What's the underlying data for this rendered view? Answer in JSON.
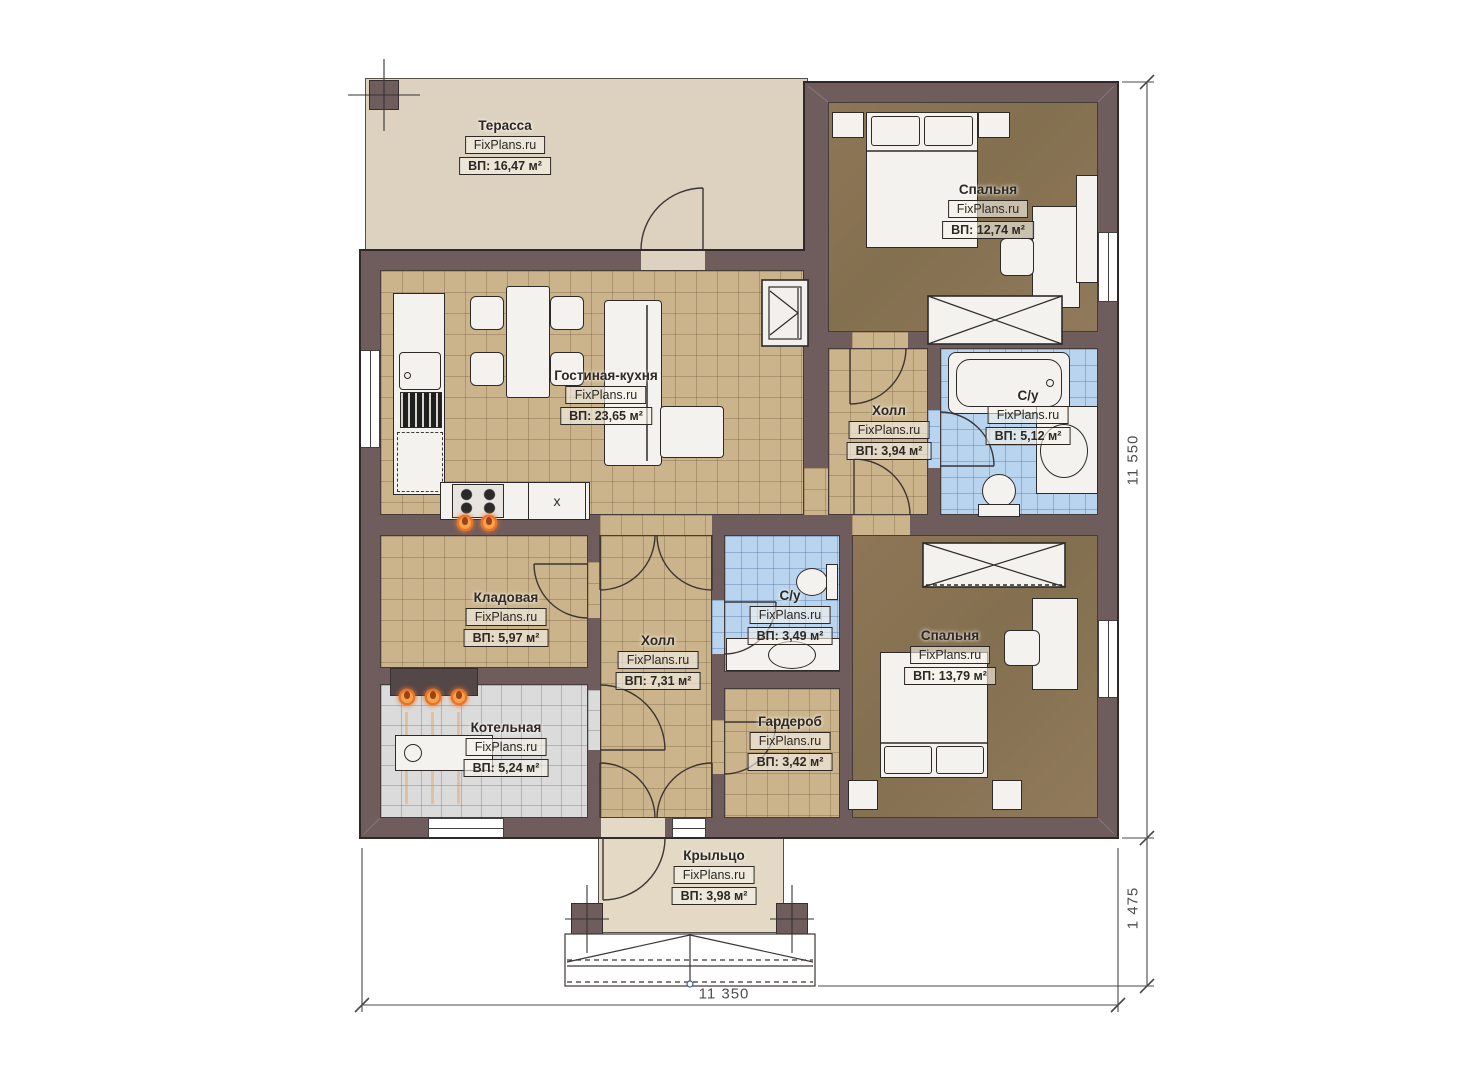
{
  "brand": "FixPlans.ru",
  "rooms": {
    "terrace": {
      "name": "Терасса",
      "area": "ВП: 16,47 м²"
    },
    "bedroom1": {
      "name": "Спальня",
      "area": "ВП: 12,74 м²"
    },
    "living": {
      "name": "Гостиная-кухня",
      "area": "ВП: 23,65 м²"
    },
    "hall1": {
      "name": "Холл",
      "area": "ВП: 3,94 м²"
    },
    "bath1": {
      "name": "С/у",
      "area": "ВП: 5,12 м²"
    },
    "pantry": {
      "name": "Кладовая",
      "area": "ВП: 5,97 м²"
    },
    "hall2": {
      "name": "Холл",
      "area": "ВП: 7,31 м²"
    },
    "bath2": {
      "name": "С/у",
      "area": "ВП: 3,49 м²"
    },
    "boiler": {
      "name": "Котельная",
      "area": "ВП: 5,24 м²"
    },
    "wardrobe": {
      "name": "Гардероб",
      "area": "ВП: 3,42 м²"
    },
    "bedroom2": {
      "name": "Спальня",
      "area": "ВП: 13,79 м²"
    },
    "porch": {
      "name": "Крыльцо",
      "area": "ВП: 3,98 м²"
    }
  },
  "appliances": {
    "kitchen_marker": "x"
  },
  "dimensions": {
    "height_total": "11 550",
    "porch_depth": "1 475",
    "width_total": "11 350"
  },
  "colors": {
    "wall": "#6f5d5e",
    "floor_tile": "#cbb48c",
    "floor_wood": "#8a7355",
    "bath_tile": "#b9d4ee",
    "boiler_tile": "#dbdbdb",
    "terrace": "#ddd2bf",
    "accent_flame": "#e8742a"
  }
}
